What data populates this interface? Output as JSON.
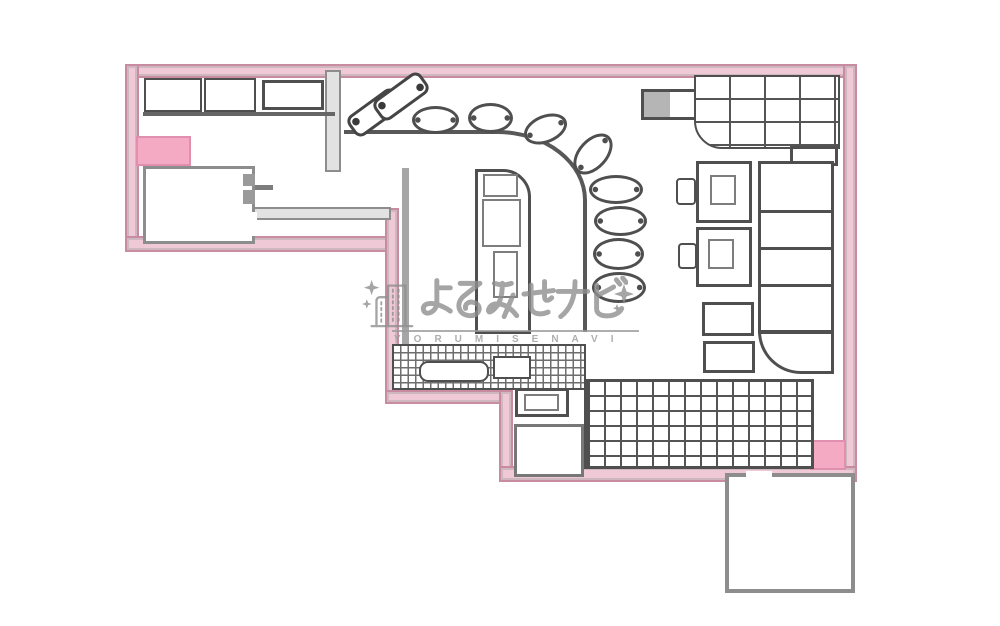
{
  "figure": {
    "kind": "scanned floor plan drawing",
    "subject": "bar / izakaya interior layout with pink outer walls"
  },
  "watermark": {
    "brand_jp": "よるみせナビ",
    "brand_en": "YORUMISENAVI",
    "icons": [
      "building-icon",
      "sparkle-icon"
    ]
  },
  "inventory": {
    "counter_stools": 8,
    "tilted_tables": 2,
    "square_tables_with_chairs": 2,
    "small_tables": 2,
    "bench_segments": 4,
    "grid_areas": 2,
    "rooms": 2,
    "pink_highlight_blocks": 2
  },
  "colors": {
    "wall-fill": "#efc9d6",
    "wall-line": "#c98ba2",
    "wall-accent-fill": "#f3aac2",
    "wall-accent-line": "#e08fae",
    "ink": "#4f4f4f",
    "ink-soft": "#7d7d7d",
    "gray-wall-fill": "#e2e2e2",
    "gray-wall-line": "#8d8d8d",
    "watermark": "#8f8f8f",
    "paper": "#ffffff"
  }
}
